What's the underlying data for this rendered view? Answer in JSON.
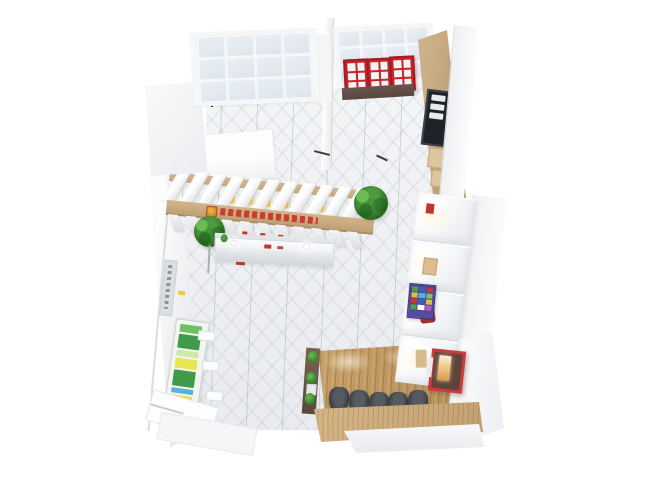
{
  "scene": {
    "type": "3d-interior-floorplan-render",
    "description": "Top-down 3D render of a small retail shop interior with display pergola, bar seating and lit wall niches",
    "background": "#ffffff"
  },
  "palette": {
    "marble_floor": "#eef0f2",
    "wall_white": "#f4f5f7",
    "wall_edge": "#d9dcdf",
    "window_glass": "#e3eaf0",
    "accent_red": "#c4262c",
    "case_base_brown": "#5c4a44",
    "wood_wall": "#c4a87e",
    "pergola_beam": "#c9a97a",
    "wood_floor": "#c49e66",
    "bar_counter_wood": "#cfae7f",
    "stool_dark": "#3a3e43",
    "plant_green": "#3e8f3a",
    "planter_brown": "#6d5844",
    "niche_glow": "#f7e3c2",
    "poster_purple": "#4f418f",
    "menu_board_dark": "#1f2329",
    "threshold_dark": "#2f2f2f"
  },
  "windows": {
    "top_left": {
      "cols": 4,
      "rows": 3
    },
    "top_right": {
      "cols": 4,
      "rows": 3
    }
  },
  "red_display_cases": {
    "count": 3,
    "rows": 3,
    "cols": 2,
    "color": "#c4262c",
    "base_color": "#5c4a44"
  },
  "menu_board": {
    "rows": 3
  },
  "pergola": {
    "fin_count": 11,
    "yellow_item_x": [
      58,
      76,
      94,
      112,
      148
    ],
    "red_dot_x": [
      78,
      96,
      114
    ],
    "sign_color": "#cc3a30",
    "beam_color": "#c9a97a"
  },
  "plants": {
    "large_count": 2
  },
  "display_counter": {
    "lights": 2,
    "red_items": 2
  },
  "left_wall": {
    "ledges": 3,
    "sign_dashes": true,
    "yellow_tag_color": "#e8c93f",
    "poster_blocks": [
      {
        "c": "#6fbf63",
        "h": 8
      },
      {
        "c": "#3f9a4c",
        "h": 14
      },
      {
        "c": "#cfe7a8",
        "h": 6
      },
      {
        "c": "#e8e650",
        "h": 10
      },
      {
        "c": "#3f9a4c",
        "h": 16
      },
      {
        "c": "#58b1d8",
        "h": 5
      },
      {
        "c": "#e4e04e",
        "h": 8
      },
      {
        "c": "#3f9a4c",
        "h": 12
      }
    ]
  },
  "right_wall_niches": [
    {
      "item": "red-tag"
    },
    {
      "item": "tan-box"
    },
    {
      "item": "red-garment"
    },
    {
      "item": "tan-boot"
    }
  ],
  "purple_poster": {
    "bg": "#4f418f",
    "squares": [
      "#49a24a",
      "#3b62b5",
      "#c43b33",
      "#e0c23a",
      "#58b1d8",
      "#7cc465",
      "#c43b33",
      "#3b62b5",
      "#e0c23a",
      "#49a24a",
      "#ffffff",
      "#b05cc1"
    ]
  },
  "bar_area": {
    "stools": 5,
    "stool_color": "#3a3e43",
    "planter_tufts": 3,
    "machine_color": "#c8373a"
  }
}
